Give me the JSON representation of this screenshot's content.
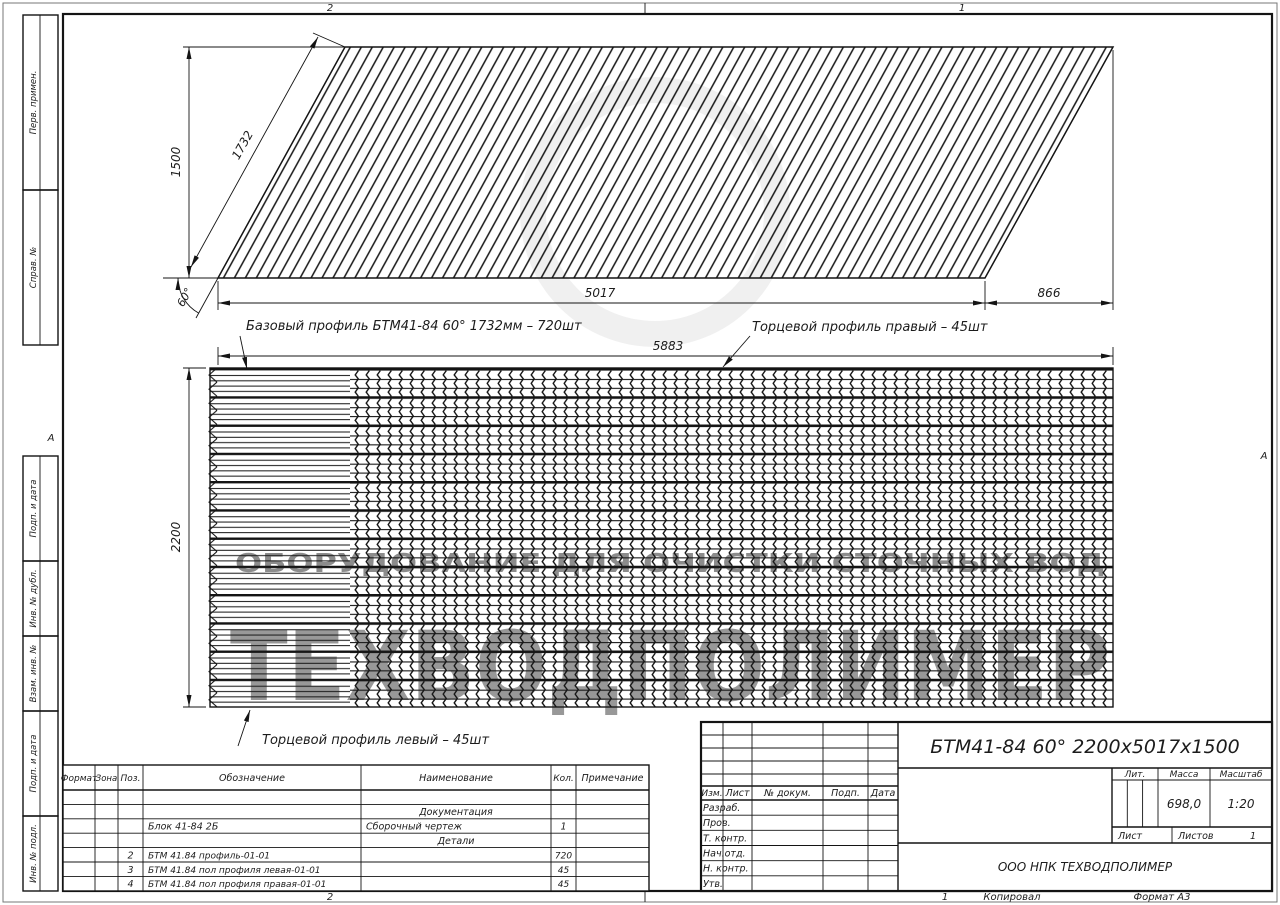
{
  "frame": {
    "fold_top_left": "2",
    "fold_top_right": "1",
    "fold_bottom_left": "2",
    "fold_bottom_right": "1",
    "fold_left": "А",
    "fold_right": "А",
    "copied": "Копировал",
    "format": "Формат А3"
  },
  "margin_labels": [
    "Перв. примен.",
    "Справ. №",
    "Подп. и дата",
    "Инв. № дубл.",
    "Взам. инв. №",
    "Подп. и дата",
    "Инв. № подл."
  ],
  "dims": {
    "v1500": "1500",
    "s1732": "1732",
    "a60": "60°",
    "w5017": "5017",
    "w866": "866",
    "w5883": "5883",
    "h2200": "2200"
  },
  "labels": {
    "base_profile": "Базовый профиль БТМ41-84 60° 1732мм – 720шт",
    "end_profile_right": "Торцевой профиль правый – 45шт",
    "end_profile_left": "Торцевой профиль левый – 45шт"
  },
  "watermark": {
    "small": "ОБОРУДОВАНИЕ ДЛЯ ОЧИСТКИ СТОЧНЫХ ВОД",
    "big": "ТЕХВОДПОЛИМЕР"
  },
  "title_block": {
    "title": "БТМ41-84 60° 2200x5017x1500",
    "org": "ООО НПК ТЕХВОДПОЛИМЕР",
    "cols": {
      "izm": "Изм.",
      "list": "Лист",
      "doc": "№ докум.",
      "sign": "Подп.",
      "date": "Дата"
    },
    "rows": [
      "Разраб.",
      "Пров.",
      "Т. контр.",
      "Нач.отд.",
      "Н. контр.",
      "Утв."
    ],
    "lit": "Лит.",
    "mass_label": "Масса",
    "scale_label": "Масштаб",
    "mass": "698,0",
    "scale": "1:20",
    "sheet_label": "Лист",
    "sheets_label": "Листов",
    "sheets": "1"
  },
  "spec": {
    "headers": [
      "Формат",
      "Зона",
      "Поз.",
      "Обозначение",
      "Наименование",
      "Кол.",
      "Примечание"
    ],
    "rows": [
      {
        "pos": "",
        "designation": "",
        "name": "Документация",
        "qty": ""
      },
      {
        "pos": "",
        "designation": "Блок 41-84 2Б",
        "name": "Сборочный чертеж",
        "qty": "1"
      },
      {
        "pos": "",
        "designation": "",
        "name": "Детали",
        "qty": ""
      },
      {
        "pos": "2",
        "designation": "БТМ 41.84 профиль-01-01",
        "name": "",
        "qty": "720"
      },
      {
        "pos": "3",
        "designation": "БТМ 41.84 пол профиля левая-01-01",
        "name": "",
        "qty": "45"
      },
      {
        "pos": "4",
        "designation": "БТМ 41.84 пол профиля правая-01-01",
        "name": "",
        "qty": "45"
      }
    ]
  }
}
